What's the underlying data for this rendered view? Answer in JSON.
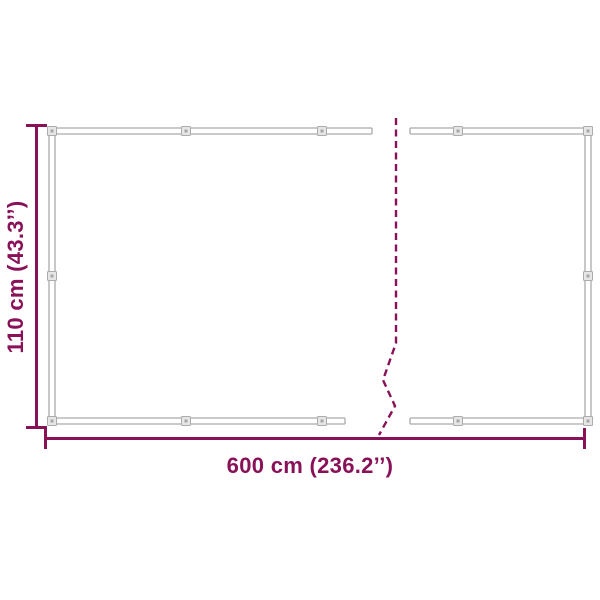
{
  "diagram": {
    "name": "balcony-privacy-screen-dimension-diagram",
    "height_label": "110 cm (43.3’’)",
    "width_label": "600 cm (236.2’’)"
  },
  "colors": {
    "dimension": "#891158",
    "frame-line": "#ababab",
    "clip-fill": "#e6e6e6",
    "clip-inner": "#a5a5a5",
    "background": "#ffffff"
  }
}
